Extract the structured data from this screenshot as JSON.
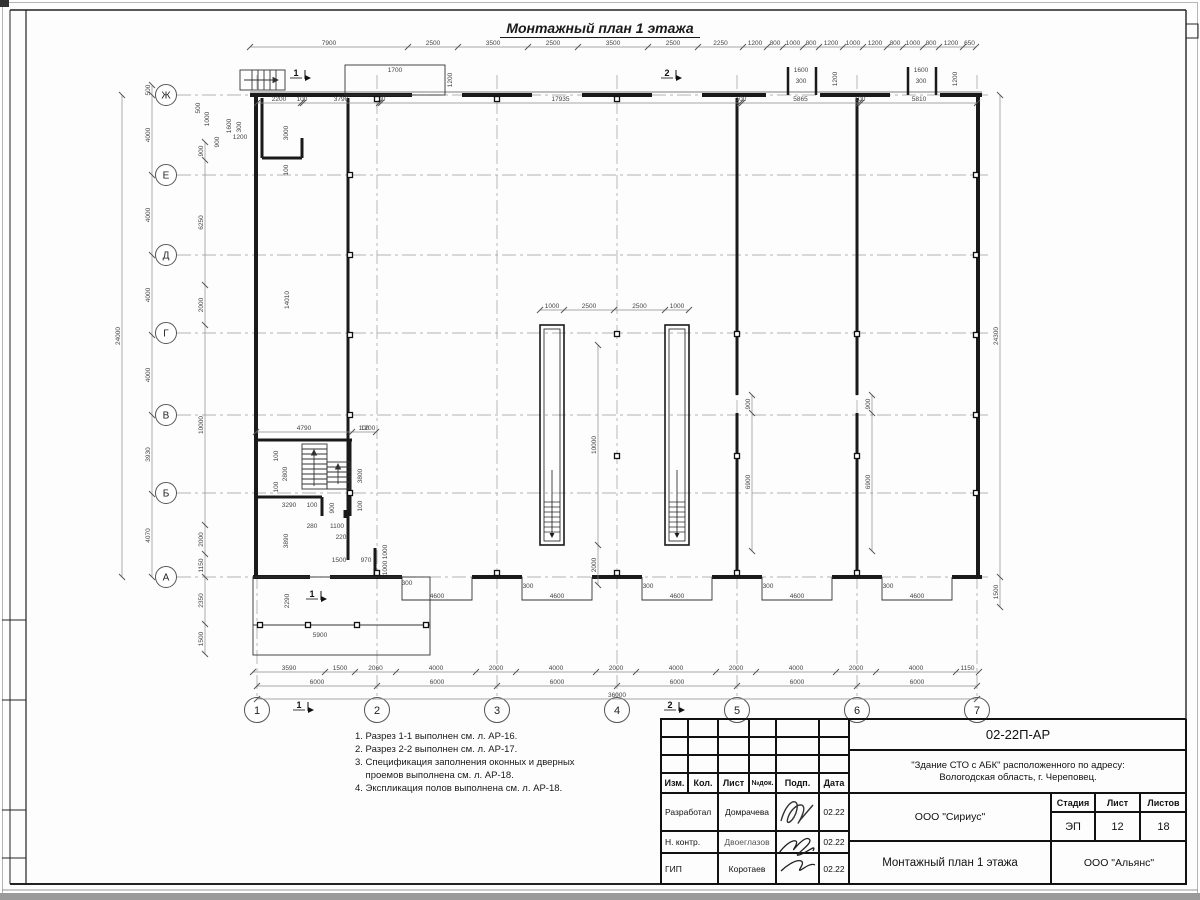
{
  "sheet": {
    "title": "Монтажный план 1 этажа",
    "notes": [
      "1. Разрез 1-1 выполнен см. л. АР-16.",
      "2. Разрез 2-2 выполнен см. л. АР-17.",
      "3. Спецификация заполнения оконных и дверных",
      "    проемов выполнена см. л. АР-18.",
      "4. Экспликация полов выполнена см. л. АР-18."
    ]
  },
  "axes": {
    "letters": [
      "Ж",
      "Е",
      "Д",
      "Г",
      "В",
      "Б",
      "А"
    ],
    "letter_y": [
      95,
      175,
      255,
      333,
      415,
      493,
      577
    ],
    "numbers": [
      "1",
      "2",
      "3",
      "4",
      "5",
      "6",
      "7"
    ],
    "number_x": [
      257,
      377,
      497,
      617,
      737,
      857,
      977
    ]
  },
  "section_marks": [
    {
      "t": "1",
      "x": 296,
      "y": 76
    },
    {
      "t": "2",
      "x": 667,
      "y": 76
    },
    {
      "t": "1",
      "x": 299,
      "y": 708
    },
    {
      "t": "2",
      "x": 670,
      "y": 708
    },
    {
      "t": "1",
      "x": 312,
      "y": 597
    }
  ],
  "plan": {
    "chains": [
      {
        "o": "h",
        "pos": 47,
        "stops": [
          250,
          408,
          458,
          528,
          578,
          648,
          698,
          743,
          767,
          783,
          803,
          819,
          843,
          863,
          887,
          903,
          923,
          939,
          963,
          976
        ],
        "labels": [
          "7900",
          "2500",
          "3500",
          "2500",
          "3500",
          "2500",
          "2250",
          "1200",
          "800",
          "1000",
          "800",
          "1200",
          "1000",
          "1200",
          "800",
          "1000",
          "800",
          "1200",
          "650"
        ]
      },
      {
        "o": "h",
        "pos": 103,
        "stops": [
          257,
          301,
          303,
          379,
          381,
          740,
          742,
          859,
          861,
          977
        ],
        "labels": [
          "2200",
          "100",
          "3790",
          "100",
          "17935",
          "100",
          "5865",
          "100",
          "5810"
        ]
      },
      {
        "o": "v",
        "pos": 122,
        "stops": [
          95,
          577
        ],
        "labels": [
          "24000"
        ]
      },
      {
        "o": "v",
        "pos": 152,
        "stops": [
          85,
          95,
          175,
          255,
          335,
          415,
          494,
          577
        ],
        "labels": [
          "500",
          "4000",
          "4000",
          "4000",
          "4000",
          "3930",
          "4070"
        ]
      },
      {
        "o": "v",
        "pos": 205,
        "stops": [
          142,
          160,
          285,
          325,
          525,
          554,
          577,
          624,
          654
        ],
        "labels": [
          "900",
          "6250",
          "2000",
          "10000",
          "2000",
          "1150",
          "2350",
          "1500"
        ]
      },
      {
        "o": "v",
        "pos": 1000,
        "stops": [
          95,
          577,
          607
        ],
        "labels": [
          "24300",
          "1500"
        ]
      },
      {
        "o": "h",
        "pos": 672,
        "stops": [
          253,
          325,
          355,
          396,
          476,
          516,
          596,
          636,
          716,
          756,
          836,
          876,
          956,
          979
        ],
        "labels": [
          "3590",
          "1500",
          "2060",
          "4000",
          "2000",
          "4000",
          "2000",
          "4000",
          "2000",
          "4000",
          "2000",
          "4000",
          "1150"
        ]
      },
      {
        "o": "h",
        "pos": 686,
        "stops": [
          257,
          377,
          497,
          617,
          737,
          857,
          977
        ],
        "labels": [
          "6000",
          "6000",
          "6000",
          "6000",
          "6000",
          "6000"
        ]
      },
      {
        "o": "h",
        "pos": 699,
        "stops": [
          257,
          977
        ],
        "labels": [
          "36000"
        ]
      },
      {
        "o": "h",
        "pos": 310,
        "stops": [
          540,
          564,
          614,
          665,
          689
        ],
        "labels": [
          "1000",
          "2500",
          "2500",
          "1000"
        ]
      },
      {
        "o": "v",
        "pos": 598,
        "stops": [
          345,
          545,
          585
        ],
        "labels": [
          "10000",
          "2000"
        ]
      },
      {
        "o": "v",
        "pos": 752,
        "stops": [
          395,
          413,
          551
        ],
        "labels": [
          "900",
          "6900"
        ]
      },
      {
        "o": "v",
        "pos": 872,
        "stops": [
          395,
          413,
          551
        ],
        "labels": [
          "900",
          "6900"
        ]
      },
      {
        "o": "h",
        "pos": 432,
        "stops": [
          256,
          352,
          376
        ],
        "labels": [
          "4790",
          "100"
        ]
      }
    ],
    "free_labels": [
      {
        "t": "1700",
        "x": 395,
        "y": 72
      },
      {
        "t": "1200",
        "x": 452,
        "y": 80,
        "r": 1
      },
      {
        "t": "1600",
        "x": 801,
        "y": 72
      },
      {
        "t": "300",
        "x": 801,
        "y": 83
      },
      {
        "t": "1200",
        "x": 837,
        "y": 79,
        "r": 1
      },
      {
        "t": "1600",
        "x": 921,
        "y": 72
      },
      {
        "t": "300",
        "x": 921,
        "y": 83
      },
      {
        "t": "1200",
        "x": 957,
        "y": 79,
        "r": 1
      },
      {
        "t": "500",
        "x": 200,
        "y": 108,
        "r": 1
      },
      {
        "t": "1000",
        "x": 209,
        "y": 119,
        "r": 1
      },
      {
        "t": "1600",
        "x": 231,
        "y": 126,
        "r": 1
      },
      {
        "t": "300",
        "x": 241,
        "y": 127,
        "r": 1
      },
      {
        "t": "900",
        "x": 219,
        "y": 142,
        "r": 1
      },
      {
        "t": "1200",
        "x": 240,
        "y": 139
      },
      {
        "t": "3000",
        "x": 288,
        "y": 133,
        "r": 1
      },
      {
        "t": "100",
        "x": 288,
        "y": 170,
        "r": 1
      },
      {
        "t": "14010",
        "x": 289,
        "y": 300,
        "r": 1
      },
      {
        "t": "1200",
        "x": 368,
        "y": 430
      },
      {
        "t": "100",
        "x": 278,
        "y": 456,
        "r": 1
      },
      {
        "t": "2800",
        "x": 287,
        "y": 474,
        "r": 1
      },
      {
        "t": "100",
        "x": 278,
        "y": 487,
        "r": 1
      },
      {
        "t": "3290",
        "x": 289,
        "y": 507
      },
      {
        "t": "100",
        "x": 312,
        "y": 507
      },
      {
        "t": "900",
        "x": 334,
        "y": 508,
        "r": 1
      },
      {
        "t": "280",
        "x": 312,
        "y": 528
      },
      {
        "t": "1100",
        "x": 337,
        "y": 528
      },
      {
        "t": "220",
        "x": 341,
        "y": 539
      },
      {
        "t": "3800",
        "x": 362,
        "y": 476,
        "r": 1
      },
      {
        "t": "100",
        "x": 362,
        "y": 506,
        "r": 1
      },
      {
        "t": "3890",
        "x": 288,
        "y": 541,
        "r": 1
      },
      {
        "t": "1500",
        "x": 339,
        "y": 562
      },
      {
        "t": "970",
        "x": 366,
        "y": 562
      },
      {
        "t": "1000",
        "x": 387,
        "y": 552,
        "r": 1
      },
      {
        "t": "1000",
        "x": 387,
        "y": 568,
        "r": 1
      },
      {
        "t": "300",
        "x": 407,
        "y": 585
      },
      {
        "t": "2290",
        "x": 289,
        "y": 601,
        "r": 1
      },
      {
        "t": "5900",
        "x": 320,
        "y": 637
      },
      {
        "t": "4600",
        "x": 437,
        "y": 598
      },
      {
        "t": "300",
        "x": 528,
        "y": 588
      },
      {
        "t": "4600",
        "x": 557,
        "y": 598
      },
      {
        "t": "300",
        "x": 648,
        "y": 588
      },
      {
        "t": "4600",
        "x": 677,
        "y": 598
      },
      {
        "t": "300",
        "x": 768,
        "y": 588
      },
      {
        "t": "4600",
        "x": 797,
        "y": 598
      },
      {
        "t": "300",
        "x": 888,
        "y": 588
      },
      {
        "t": "4600",
        "x": 917,
        "y": 598
      }
    ],
    "squares": [
      [
        377,
        99
      ],
      [
        497,
        99
      ],
      [
        617,
        99
      ],
      [
        617,
        334
      ],
      [
        617,
        456
      ],
      [
        350,
        175
      ],
      [
        350,
        255
      ],
      [
        350,
        335
      ],
      [
        350,
        415
      ],
      [
        350,
        493
      ],
      [
        976,
        175
      ],
      [
        976,
        255
      ],
      [
        976,
        335
      ],
      [
        976,
        415
      ],
      [
        976,
        493
      ],
      [
        737,
        334
      ],
      [
        737,
        456
      ],
      [
        857,
        334
      ],
      [
        857,
        456
      ],
      [
        377,
        573
      ],
      [
        497,
        573
      ],
      [
        617,
        573
      ],
      [
        737,
        573
      ],
      [
        857,
        573
      ],
      [
        260,
        625
      ],
      [
        308,
        625
      ],
      [
        357,
        625
      ],
      [
        426,
        625
      ]
    ]
  },
  "title_block": {
    "doc_code": "02-22П-АР",
    "project_line1": "\"Здание СТО с АБК\" расположенного по адресу:",
    "project_line2": "Вологодская область, г. Череповец.",
    "org": "ООО \"Сириус\"",
    "drawing_title": "Монтажный план 1 этажа",
    "contractor": "ООО \"Альянс\"",
    "stage_label": "Стадия",
    "sheet_label": "Лист",
    "sheets_label": "Листов",
    "stage": "ЭП",
    "sheet_no": "12",
    "sheets_total": "18",
    "col_headers": {
      "izm": "Изм.",
      "kol": "Кол.",
      "list": "Лист",
      "ndok": "№док.",
      "podp": "Подп.",
      "data": "Дата"
    },
    "rows": [
      {
        "role": "Разработал",
        "name": "Домрачева",
        "date": "02.22"
      },
      {
        "role": "Н. контр.",
        "name": "Двоеглазов",
        "date": "02.22"
      },
      {
        "role": "ГИП",
        "name": "Коротаев",
        "date": "02.22"
      }
    ]
  }
}
